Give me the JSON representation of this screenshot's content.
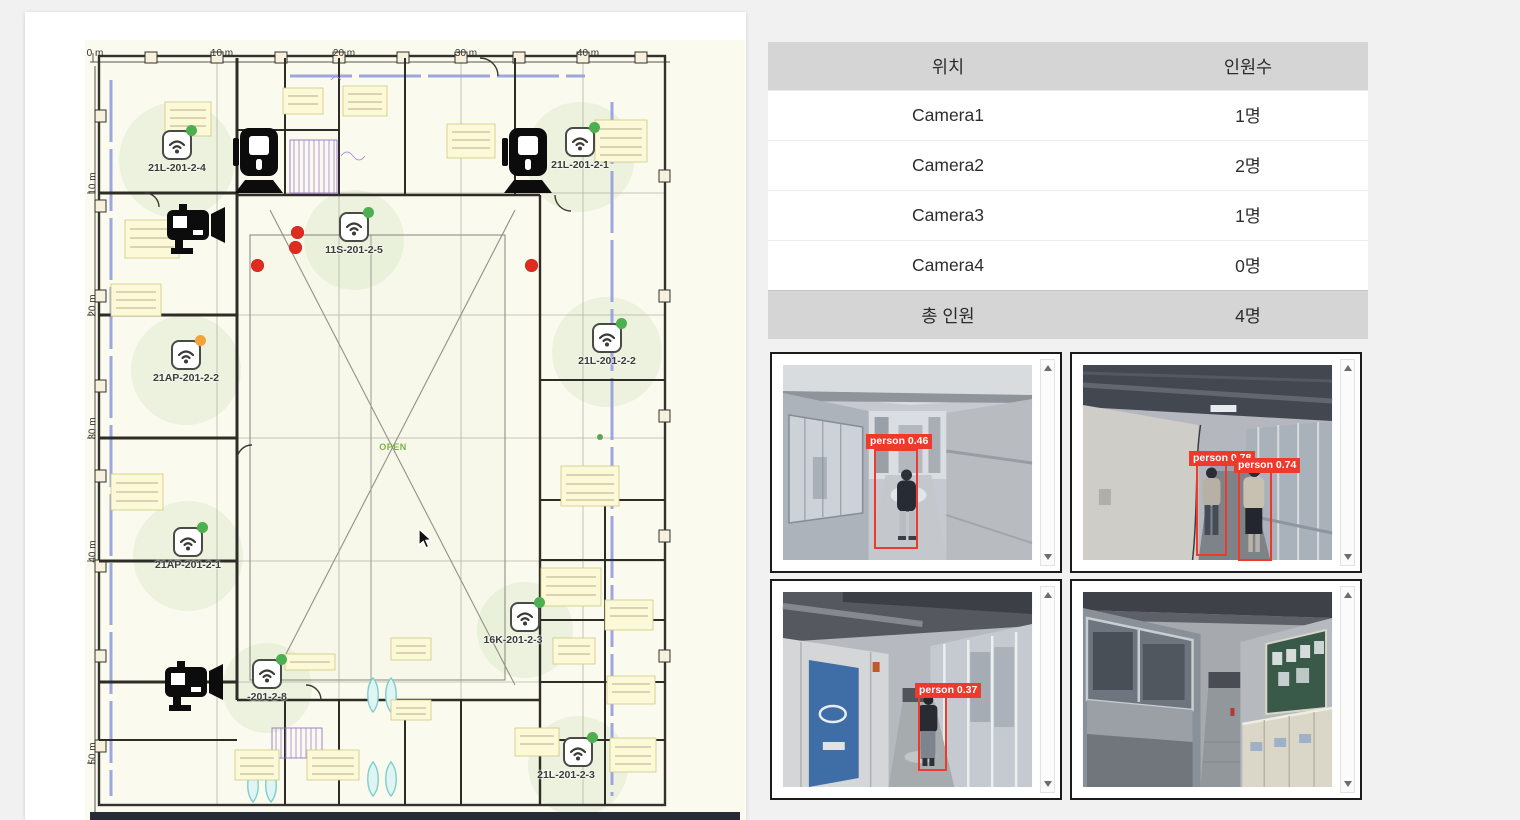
{
  "window": {
    "background": "#f1f1f1"
  },
  "floor_plan": {
    "top_ruler": [
      "0 m",
      "10 m",
      "20 m",
      "30 m",
      "40 m"
    ],
    "left_ruler": [
      "10 m",
      "20 m",
      "30 m",
      "40 m",
      "50 m"
    ],
    "open_label": "OPEN",
    "access_points": [
      {
        "id": "21L-201-2-4",
        "status_color": "#4caf50"
      },
      {
        "id": "21L-201-2-1",
        "status_color": "#4caf50"
      },
      {
        "id": "11S-201-2-5",
        "status_color": "#4caf50"
      },
      {
        "id": "21AP-201-2-2",
        "status_color": "#f2a33c"
      },
      {
        "id": "21L-201-2-2",
        "status_color": "#4caf50"
      },
      {
        "id": "21AP-201-2-1",
        "status_color": "#4caf50"
      },
      {
        "id": "16K-201-2-3",
        "status_color": "#4caf50"
      },
      {
        "id": "-201-2-8",
        "status_color": "#4caf50"
      },
      {
        "id": "21L-201-2-3",
        "status_color": "#4caf50"
      }
    ],
    "camera_marker_count": 4,
    "detection_dot_count": 4
  },
  "occupancy_table": {
    "col_location": "위치",
    "col_count": "인원수",
    "rows": [
      {
        "location": "Camera1",
        "count": "1명"
      },
      {
        "location": "Camera2",
        "count": "2명"
      },
      {
        "location": "Camera3",
        "count": "1명"
      },
      {
        "location": "Camera4",
        "count": "0명"
      }
    ],
    "total_label": "총 인원",
    "total_count": "4명"
  },
  "camera_feeds": [
    {
      "name": "camera1",
      "detections": [
        {
          "label": "person 0.46"
        }
      ]
    },
    {
      "name": "camera2",
      "detections": [
        {
          "label": "person 0.78"
        },
        {
          "label": "person 0.74"
        }
      ]
    },
    {
      "name": "camera3",
      "detections": [
        {
          "label": "person 0.37"
        }
      ]
    },
    {
      "name": "camera4",
      "detections": []
    }
  ],
  "colors": {
    "detection_red": "#ee3a2c",
    "ap_green": "#4caf50",
    "ap_orange": "#f2a33c",
    "table_header_bg": "#d5d5d5"
  }
}
